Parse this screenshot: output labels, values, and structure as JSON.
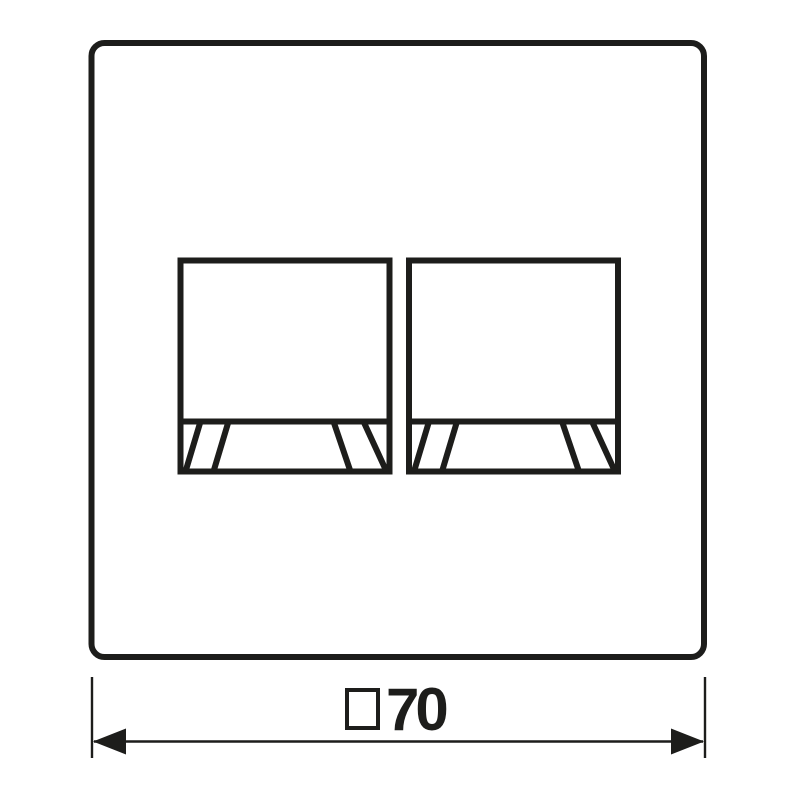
{
  "colors": {
    "line": "#1d1d1b",
    "background": "#ffffff"
  },
  "drawing": {
    "dimension": {
      "symbol": "□",
      "value": "70",
      "label": "□70"
    }
  }
}
